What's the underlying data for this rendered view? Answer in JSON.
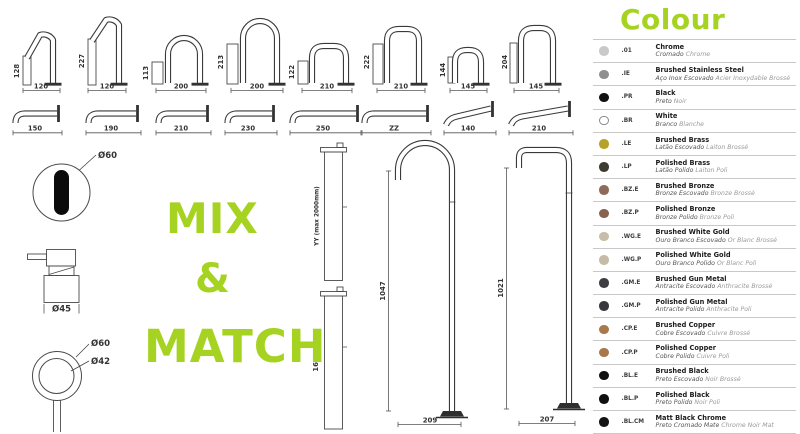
{
  "accent": "#a6d321",
  "mix_match": {
    "line1": "MIX",
    "line2": "&",
    "line3": "MATCH"
  },
  "top_spouts": [
    {
      "height": "128",
      "width": "120"
    },
    {
      "height": "227",
      "width": "120"
    },
    {
      "height": "113",
      "width": "200"
    },
    {
      "height": "213",
      "width": "200"
    },
    {
      "height": "122",
      "width": "210"
    },
    {
      "height": "222",
      "width": "210"
    },
    {
      "height": "144",
      "width": "145"
    },
    {
      "height": "204",
      "width": "145"
    }
  ],
  "wall_spouts": [
    {
      "width": "150"
    },
    {
      "width": "190"
    },
    {
      "width": "210"
    },
    {
      "width": "230"
    },
    {
      "width": "250"
    },
    {
      "width": "ZZ"
    },
    {
      "width": "140"
    },
    {
      "width": "210"
    }
  ],
  "fixtures": {
    "sensor_diameter": "Ø60",
    "handle_diameter": "Ø45",
    "knob_outer_diameter": "Ø60",
    "knob_inner_diameter": "Ø42"
  },
  "risers": [
    {
      "height": "YY (max 2000mm)"
    },
    {
      "height": "1605"
    }
  ],
  "floor_spouts": [
    {
      "height": "1047",
      "width": "209"
    },
    {
      "height": "1021",
      "width": "207"
    }
  ],
  "colour": {
    "title": "Colour",
    "items": [
      {
        "code": ".01",
        "name": "Chrome",
        "name_pt": "Cromado",
        "name_fr": "Chrome",
        "dot": "#c9c9c9",
        "ring": false
      },
      {
        "code": ".IE",
        "name": "Brushed Stainless Steel",
        "name_pt": "Aço Inox Escovado",
        "name_fr": "Acier Inoxydable Brossé",
        "dot": "#8f8f8f",
        "ring": false
      },
      {
        "code": ".PR",
        "name": "Black",
        "name_pt": "Preto",
        "name_fr": "Noir",
        "dot": "#121212",
        "ring": false
      },
      {
        "code": ".BR",
        "name": "White",
        "name_pt": "Branco",
        "name_fr": "Blanche",
        "dot": "#ffffff",
        "ring": true
      },
      {
        "code": ".LE",
        "name": "Brushed Brass",
        "name_pt": "Latão Escovado",
        "name_fr": "Laiton Brossé",
        "dot": "#b5a227",
        "ring": false
      },
      {
        "code": ".LP",
        "name": "Polished Brass",
        "name_pt": "Latão Polido",
        "name_fr": "Laiton Poli",
        "dot": "#3e3b31",
        "ring": false
      },
      {
        "code": ".BZ.E",
        "name": "Brushed Bronze",
        "name_pt": "Bronze Escovado",
        "name_fr": "Bronze Brossé",
        "dot": "#8d6b58",
        "ring": false
      },
      {
        "code": ".BZ.P",
        "name": "Polished Bronze",
        "name_pt": "Bronze Polido",
        "name_fr": "Bronze Poli",
        "dot": "#8a6350",
        "ring": false
      },
      {
        "code": ".WG.E",
        "name": "Brushed White Gold",
        "name_pt": "Ouro Branco Escovado",
        "name_fr": "Or Blanc Brossé",
        "dot": "#c7bda9",
        "ring": false
      },
      {
        "code": ".WG.P",
        "name": "Polished White Gold",
        "name_pt": "Ouro Branco Polido",
        "name_fr": "Or Blanc Poli",
        "dot": "#c5bba7",
        "ring": false
      },
      {
        "code": ".GM.E",
        "name": "Brushed Gun Metal",
        "name_pt": "Antracite Escovado",
        "name_fr": "Anthracite Brossé",
        "dot": "#3e3e42",
        "ring": false
      },
      {
        "code": ".GM.P",
        "name": "Polished Gun Metal",
        "name_pt": "Antracite Polido",
        "name_fr": "Anthracite Poli",
        "dot": "#38383c",
        "ring": false
      },
      {
        "code": ".CP.E",
        "name": "Brushed Copper",
        "name_pt": "Cobre Escovado",
        "name_fr": "Cuivre Brossé",
        "dot": "#a9794b",
        "ring": false
      },
      {
        "code": ".CP.P",
        "name": "Polished Copper",
        "name_pt": "Cobre Polido",
        "name_fr": "Cuivre Poli",
        "dot": "#a87848",
        "ring": false
      },
      {
        "code": ".BL.E",
        "name": "Brushed Black",
        "name_pt": "Preto Escovado",
        "name_fr": "Noir Brossé",
        "dot": "#101010",
        "ring": false
      },
      {
        "code": ".BL.P",
        "name": "Polished Black",
        "name_pt": "Preto Polido",
        "name_fr": "Noir Poli",
        "dot": "#0f0f0f",
        "ring": false
      },
      {
        "code": ".BL.CM",
        "name": "Matt Black Chrome",
        "name_pt": "Preto Cromado Mate",
        "name_fr": "Chrome Noir Mat",
        "dot": "#141414",
        "ring": false
      }
    ]
  }
}
